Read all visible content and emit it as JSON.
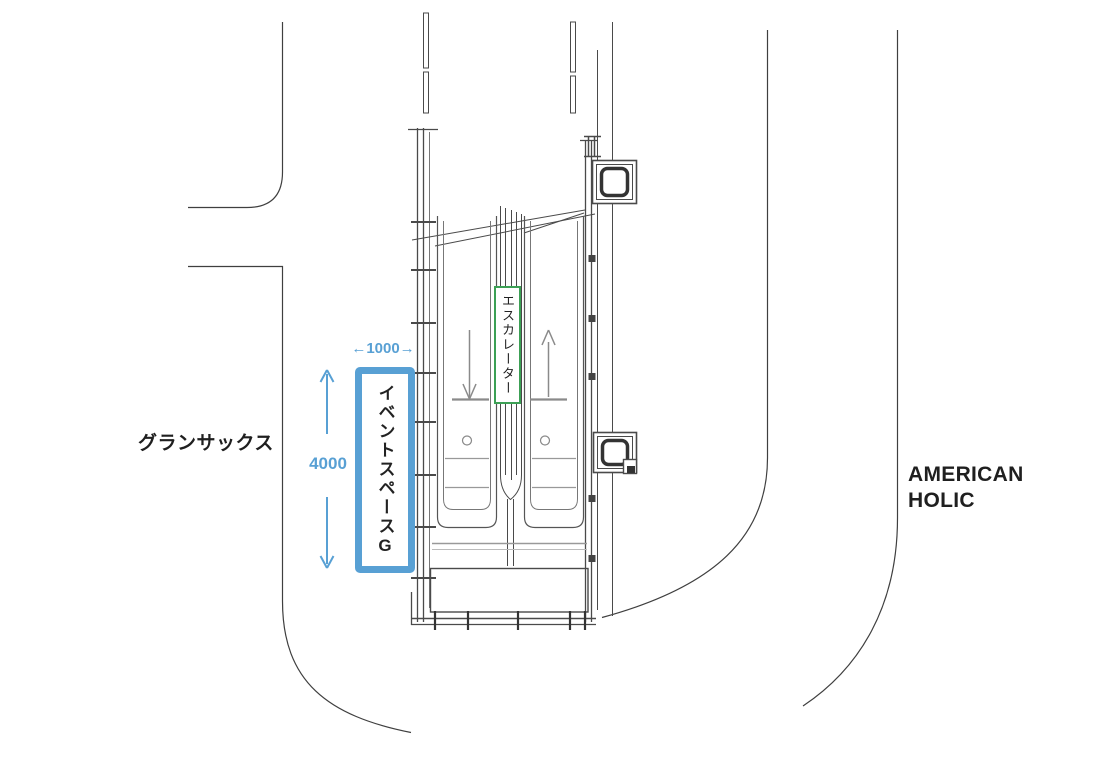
{
  "labels": {
    "left_store": "グランサックス",
    "right_store": "AMERICAN HOLIC",
    "escalator": "エスカレーター",
    "event_space_kana": "イベントスペース",
    "event_space_letter": "G"
  },
  "dimensions": {
    "width_label": "←1000→",
    "height_label": "4000"
  },
  "colors": {
    "accent_blue": "#58A0D4",
    "accent_green": "#3CA055",
    "line_dark": "#4a4a4a",
    "line_mid": "#777777",
    "line_gray": "#999999",
    "text_black": "#1f1f1f"
  }
}
